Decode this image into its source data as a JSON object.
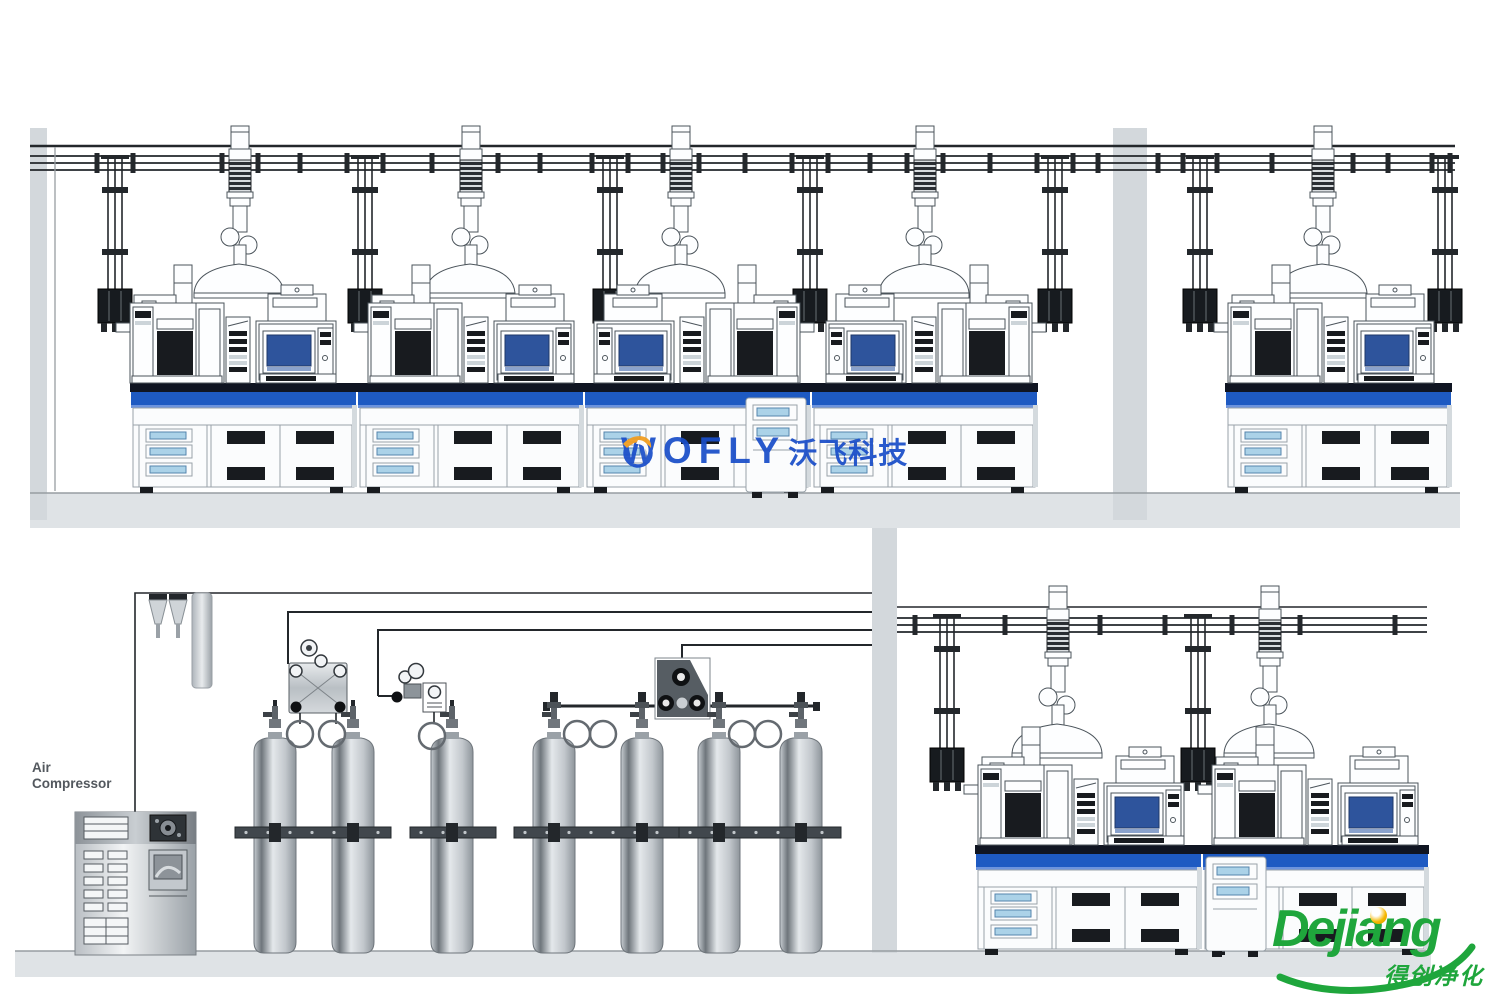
{
  "labels": {
    "air_compressor": "Air\nCompressor"
  },
  "watermark": {
    "brand": "WOFLY",
    "brand_cn": "沃飞科技",
    "icon": "swirl-logo-icon"
  },
  "vendor_logo": {
    "name": "Dejiang",
    "name_cn": "得创净化"
  },
  "colors": {
    "ink": "#23272b",
    "wall": "#d3d8dc",
    "floor": "#dfe3e6",
    "bench_top": "#101522",
    "bench_blue": "#1e5ac2",
    "screen_blue": "#2e549c",
    "drawer_blue": "#abd2e8",
    "wm_blue": "#1a4ec9",
    "logo_green": "#1fa63c",
    "logo_gold": "#f5b800"
  },
  "equipment": {
    "gas_cylinders": 7,
    "instrument_workstations": 7,
    "fume_extraction_arms": 7,
    "gas_drop_stations": 9,
    "manifold_stations": 3,
    "air_compressors": 1
  },
  "scene": {
    "rects": [
      {
        "kind": "floor",
        "x": 30,
        "y": 493,
        "w": 1430,
        "h": 35,
        "name": "upper-lab-floor"
      },
      {
        "kind": "floor",
        "x": 15,
        "y": 951,
        "w": 1416,
        "h": 26,
        "name": "lower-floor"
      },
      {
        "kind": "wall",
        "x": 30,
        "y": 128,
        "w": 17,
        "h": 392,
        "name": "upper-lab-left-wall"
      },
      {
        "kind": "wall",
        "x": 1113,
        "y": 128,
        "w": 34,
        "h": 392,
        "name": "upper-lab-divider-wall"
      },
      {
        "kind": "wall",
        "x": 872,
        "y": 528,
        "w": 25,
        "h": 425,
        "name": "lower-right-room-left-wall"
      }
    ],
    "paths": [
      {
        "d": "M30,146 H1455",
        "w": 2.6,
        "name": "main-ceiling-line"
      },
      {
        "d": "M30,156 H1455",
        "w": 1.8,
        "name": "gas-header-pipe"
      },
      {
        "d": "M30,163 H1455",
        "w": 1.8,
        "name": "gas-header-pipe"
      },
      {
        "d": "M30,170 H1455",
        "w": 1.8,
        "name": "gas-header-pipe"
      },
      {
        "d": "M55,147 V491",
        "w": 1.3,
        "cls": "edge",
        "name": "inner-wall-line"
      },
      {
        "d": "M30,493 H1460",
        "w": 1.4,
        "cls": "edge",
        "name": "upper-floor-edge"
      },
      {
        "d": "M15,951 H1431",
        "w": 1.4,
        "cls": "edge",
        "name": "lower-floor-edge"
      },
      {
        "d": "M897,607 H1427",
        "w": 1.5,
        "name": "lower-room-wall-line"
      },
      {
        "d": "M897,618 H1427",
        "w": 1.8,
        "name": "gas-header-pipe-lower"
      },
      {
        "d": "M897,625 H1427",
        "w": 1.8,
        "name": "gas-header-pipe-lower"
      },
      {
        "d": "M897,632 H1427",
        "w": 1.8,
        "name": "gas-header-pipe-lower"
      },
      {
        "d": "M135,951 V593 H872",
        "w": 1.6,
        "name": "cylinder-room-outline"
      },
      {
        "d": "M288,664 V612 H872",
        "w": 2,
        "name": "manifold-supply-pipe-1"
      },
      {
        "d": "M378,696 V630 H872",
        "w": 2,
        "name": "manifold-supply-pipe-2"
      },
      {
        "d": "M682,660 V645 H872",
        "w": 2,
        "name": "manifold-supply-pipe-3"
      },
      {
        "d": "M548,706 H815",
        "w": 3,
        "name": "cylinder-manifold-bar"
      },
      {
        "d": "M378,696 H396",
        "w": 2,
        "name": "regulator-branch-pipe"
      }
    ],
    "ticks": [
      {
        "y": 163,
        "xs": [
          97,
          133,
          222,
          258,
          300,
          347,
          383,
          432,
          462,
          498,
          540,
          592,
          628,
          663,
          699,
          745,
          792,
          828,
          870,
          907,
          943,
          990,
          1037,
          1073,
          1098,
          1158,
          1183,
          1217,
          1272,
          1317,
          1353,
          1388,
          1432,
          1450
        ]
      },
      {
        "y": 625,
        "xs": [
          915,
          1005,
          1100,
          1165,
          1232,
          1300,
          1395
        ]
      }
    ],
    "stamps": [
      {
        "ref": "drop",
        "x": 115,
        "y": 163,
        "name": "gas-drop-station"
      },
      {
        "ref": "drop",
        "x": 365,
        "y": 163,
        "name": "gas-drop-station"
      },
      {
        "ref": "drop",
        "x": 610,
        "y": 163,
        "name": "gas-drop-station"
      },
      {
        "ref": "drop",
        "x": 810,
        "y": 163,
        "name": "gas-drop-station"
      },
      {
        "ref": "drop",
        "x": 1055,
        "y": 163,
        "name": "gas-drop-station"
      },
      {
        "ref": "drop",
        "x": 1200,
        "y": 163,
        "name": "gas-drop-station"
      },
      {
        "ref": "drop",
        "x": 1445,
        "y": 163,
        "name": "gas-drop-station"
      },
      {
        "ref": "drop",
        "x": 947,
        "y": 622,
        "name": "gas-drop-station"
      },
      {
        "ref": "drop",
        "x": 1198,
        "y": 622,
        "name": "gas-drop-station"
      },
      {
        "ref": "arm",
        "x": 240,
        "y": 147,
        "name": "fume-extraction-arm"
      },
      {
        "ref": "arm",
        "x": 471,
        "y": 147,
        "name": "fume-extraction-arm"
      },
      {
        "ref": "arm",
        "x": 681,
        "y": 147,
        "name": "fume-extraction-arm"
      },
      {
        "ref": "arm",
        "x": 925,
        "y": 147,
        "name": "fume-extraction-arm"
      },
      {
        "ref": "arm",
        "x": 1323,
        "y": 147,
        "name": "fume-extraction-arm"
      },
      {
        "ref": "arm",
        "x": 1058,
        "y": 607,
        "name": "fume-extraction-arm"
      },
      {
        "ref": "arm",
        "x": 1270,
        "y": 607,
        "name": "fume-extraction-arm"
      },
      {
        "ref": "bm",
        "x": 130,
        "y": 383,
        "name": "bench-module"
      },
      {
        "ref": "bm",
        "x": 357,
        "y": 383,
        "name": "bench-module"
      },
      {
        "ref": "bm",
        "x": 584,
        "y": 383,
        "name": "bench-module"
      },
      {
        "ref": "bm",
        "x": 811,
        "y": 383,
        "name": "bench-module"
      },
      {
        "ref": "bm",
        "x": 1225,
        "y": 383,
        "name": "bench-module"
      },
      {
        "ref": "bm",
        "x": 975,
        "y": 845,
        "name": "bench-module"
      },
      {
        "ref": "bm",
        "x": 1202,
        "y": 845,
        "name": "bench-module"
      },
      {
        "ref": "ws",
        "x": 130,
        "y": 383,
        "name": "instrument-workstation"
      },
      {
        "ref": "ws",
        "x": 368,
        "y": 383,
        "name": "instrument-workstation"
      },
      {
        "ref": "ws",
        "x": 800,
        "y": 383,
        "flip": true,
        "name": "instrument-workstation"
      },
      {
        "ref": "ws",
        "x": 1032,
        "y": 383,
        "flip": true,
        "name": "instrument-workstation"
      },
      {
        "ref": "ws",
        "x": 1228,
        "y": 383,
        "name": "instrument-workstation"
      },
      {
        "ref": "ws",
        "x": 978,
        "y": 845,
        "name": "instrument-workstation"
      },
      {
        "ref": "ws",
        "x": 1212,
        "y": 845,
        "name": "instrument-workstation"
      },
      {
        "ref": "cart",
        "x": 746,
        "y": 398,
        "name": "mobile-cabinet"
      },
      {
        "ref": "cart",
        "x": 1206,
        "y": 857,
        "name": "mobile-cabinet"
      },
      {
        "ref": "cyl",
        "x": 275,
        "y": 740,
        "name": "gas-cylinder"
      },
      {
        "ref": "cyl",
        "x": 353,
        "y": 740,
        "name": "gas-cylinder"
      },
      {
        "ref": "cyl",
        "x": 452,
        "y": 740,
        "name": "gas-cylinder"
      },
      {
        "ref": "cyl",
        "x": 554,
        "y": 740,
        "name": "gas-cylinder"
      },
      {
        "ref": "cyl",
        "x": 642,
        "y": 740,
        "name": "gas-cylinder"
      },
      {
        "ref": "cyl",
        "x": 719,
        "y": 740,
        "name": "gas-cylinder"
      },
      {
        "ref": "cyl",
        "x": 801,
        "y": 740,
        "name": "gas-cylinder"
      },
      {
        "ref": "loop",
        "x": 300,
        "y": 734,
        "name": "pigtail-loop"
      },
      {
        "ref": "loop",
        "x": 332,
        "y": 734,
        "name": "pigtail-loop"
      },
      {
        "ref": "loop",
        "x": 432,
        "y": 736,
        "name": "pigtail-loop"
      },
      {
        "ref": "loop",
        "x": 577,
        "y": 734,
        "name": "pigtail-loop"
      },
      {
        "ref": "loop",
        "x": 603,
        "y": 734,
        "name": "pigtail-loop"
      },
      {
        "ref": "loop",
        "x": 742,
        "y": 734,
        "name": "pigtail-loop"
      },
      {
        "ref": "loop",
        "x": 768,
        "y": 734,
        "name": "pigtail-loop"
      },
      {
        "ref": "tee",
        "x": 554,
        "y": 706,
        "name": "manifold-valve"
      },
      {
        "ref": "tee",
        "x": 642,
        "y": 706,
        "name": "manifold-valve"
      },
      {
        "ref": "tee",
        "x": 719,
        "y": 706,
        "name": "manifold-valve"
      },
      {
        "ref": "tee",
        "x": 801,
        "y": 706,
        "name": "manifold-valve"
      }
    ],
    "bars": [
      {
        "x": 235,
        "y": 827,
        "w": 156,
        "clamps": [
          275,
          353
        ]
      },
      {
        "x": 410,
        "y": 827,
        "w": 86,
        "clamps": [
          452
        ]
      },
      {
        "x": 514,
        "y": 827,
        "w": 168,
        "clamps": [
          554,
          642
        ]
      },
      {
        "x": 679,
        "y": 827,
        "w": 162,
        "clamps": [
          719,
          801
        ]
      }
    ]
  }
}
